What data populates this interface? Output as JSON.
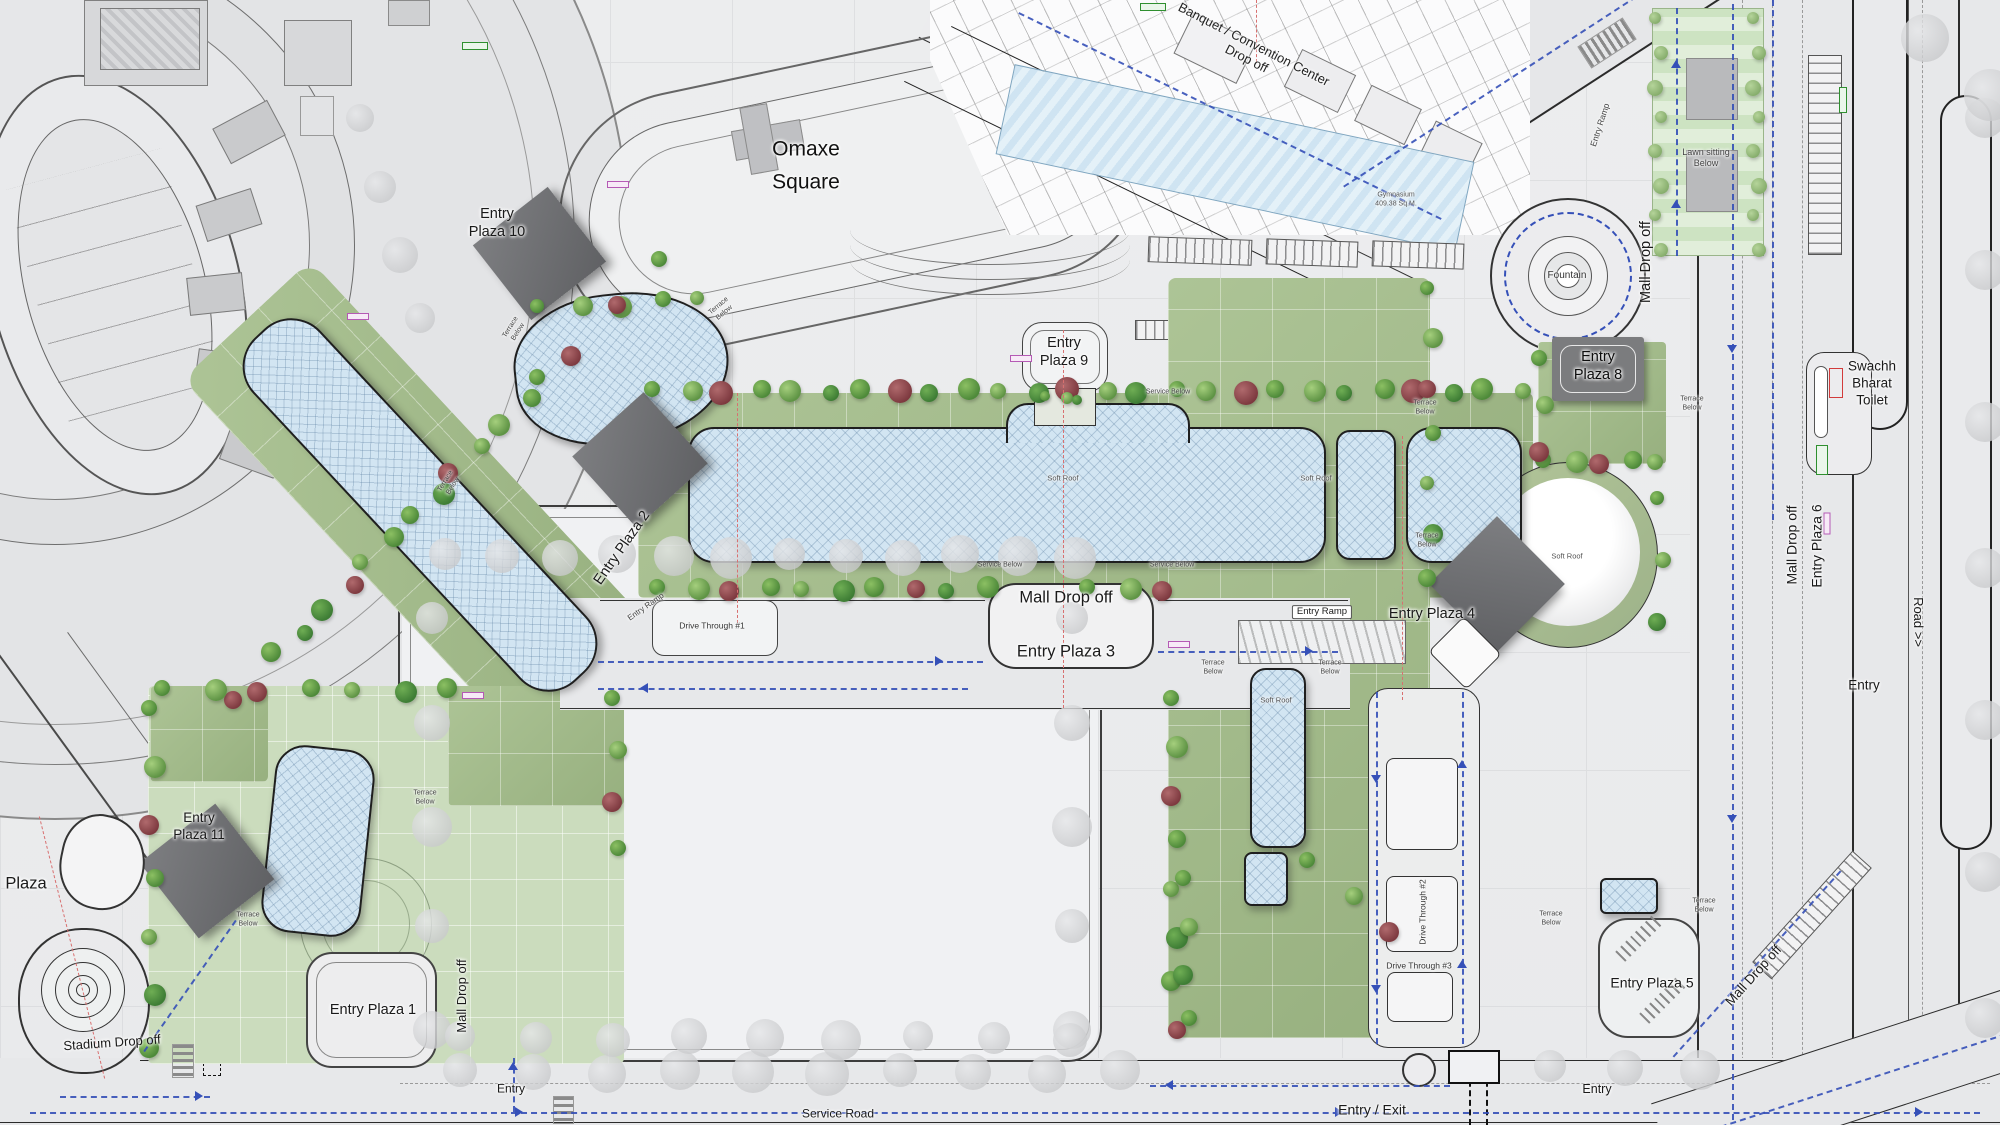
{
  "title": "Omaxe Square mall site plan",
  "colors": {
    "roof_blue": "#d2e5f2",
    "terrace_green": "#a3bb8b",
    "pale_green": "#cbdcbd",
    "plaza_marker_grey": "#6e6f71",
    "traffic_dash_blue": "#3550b8",
    "axis_dash_red": "#d87070",
    "toilet_outline_red": "#d23b3b"
  },
  "annotations": [
    {
      "id": "banquet-convention-drop-off",
      "text": "Banquet / Convention Center\nDrop off",
      "x": 1250,
      "y": 52,
      "s": 13,
      "r": 27,
      "c": "#222"
    },
    {
      "id": "omaxe-square",
      "text": "Omaxe\nSquare",
      "x": 806,
      "y": 166,
      "s": 21,
      "r": 0,
      "c": "#111",
      "lh": 1.55
    },
    {
      "id": "entry-plaza-10",
      "text": "Entry\nPlaza 10",
      "x": 497,
      "y": 223,
      "s": 14.5,
      "r": 0
    },
    {
      "id": "entry-plaza-9",
      "text": "Entry\nPlaza 9",
      "x": 1064,
      "y": 352,
      "s": 14.5,
      "r": 0
    },
    {
      "id": "entry-plaza-8",
      "text": "Entry\nPlaza 8",
      "x": 1598,
      "y": 366,
      "s": 14.5,
      "r": 0,
      "c": "#0d0d0d"
    },
    {
      "id": "fountain",
      "text": "Fountain",
      "x": 1567,
      "y": 276,
      "s": 10,
      "r": 0,
      "c": "#333"
    },
    {
      "id": "mall-drop-off-northeast",
      "text": "Mall Drop off",
      "x": 1646,
      "y": 262,
      "s": 14.5,
      "r": -90
    },
    {
      "id": "lawn-sitting-below",
      "text": "Lawn sitting\nBelow",
      "x": 1706,
      "y": 158,
      "s": 9,
      "r": 0,
      "c": "#444"
    },
    {
      "id": "swachh-bharat-toilet",
      "text": "Swachh\nBharat\nToilet",
      "x": 1872,
      "y": 384,
      "s": 13.5,
      "r": 0
    },
    {
      "id": "mall-drop-off-6",
      "text": "Mall Drop off",
      "x": 1792,
      "y": 545,
      "s": 14,
      "r": -90
    },
    {
      "id": "entry-plaza-6",
      "text": "Entry Plaza 6",
      "x": 1817,
      "y": 546,
      "s": 14,
      "r": -90
    },
    {
      "id": "road-label",
      "text": "Road >>",
      "x": 1918,
      "y": 622,
      "s": 13,
      "r": 90
    },
    {
      "id": "entry-right",
      "text": "Entry",
      "x": 1864,
      "y": 686,
      "s": 13.5,
      "r": 0
    },
    {
      "id": "entry-plaza-4",
      "text": "Entry Plaza 4",
      "x": 1432,
      "y": 614,
      "s": 14.5,
      "r": 0
    },
    {
      "id": "mall-drop-off-center",
      "text": "Mall Drop off",
      "x": 1066,
      "y": 598,
      "s": 16.5,
      "r": 0
    },
    {
      "id": "entry-plaza-3",
      "text": "Entry Plaza 3",
      "x": 1066,
      "y": 652,
      "s": 16.5,
      "r": 0
    },
    {
      "id": "entry-ramp-center",
      "text": "Entry Ramp",
      "x": 1322,
      "y": 612,
      "s": 9.5,
      "r": 0,
      "box": true
    },
    {
      "id": "entry-ramp-left",
      "text": "Entry Ramp",
      "x": 646,
      "y": 607,
      "s": 8,
      "r": -35,
      "c": "#444"
    },
    {
      "id": "entry-ramp-northeast",
      "text": "Entry Ramp",
      "x": 1600,
      "y": 125,
      "s": 8.5,
      "r": -72,
      "c": "#444"
    },
    {
      "id": "entry-plaza-2",
      "text": "Entry Plaza 2",
      "x": 622,
      "y": 548,
      "s": 14.5,
      "r": -55
    },
    {
      "id": "entry-plaza-11",
      "text": "Entry\nPlaza 11",
      "x": 199,
      "y": 827,
      "s": 13.5,
      "r": 0
    },
    {
      "id": "plaza-left",
      "text": "Plaza",
      "x": 26,
      "y": 884,
      "s": 16.5,
      "r": 0
    },
    {
      "id": "stadium-drop-off",
      "text": "Stadium Drop off",
      "x": 112,
      "y": 1043,
      "s": 13,
      "r": -4
    },
    {
      "id": "entry-plaza-1",
      "text": "Entry Plaza 1",
      "x": 373,
      "y": 1010,
      "s": 14.5,
      "r": 0
    },
    {
      "id": "mall-drop-off-southwest",
      "text": "Mall Drop off",
      "x": 462,
      "y": 996,
      "s": 13,
      "r": -90
    },
    {
      "id": "entry-southwest",
      "text": "Entry",
      "x": 511,
      "y": 1089,
      "s": 12,
      "r": 0
    },
    {
      "id": "service-road",
      "text": "Service Road",
      "x": 838,
      "y": 1114,
      "s": 12,
      "r": 0
    },
    {
      "id": "entry-exit",
      "text": "Entry / Exit",
      "x": 1372,
      "y": 1110,
      "s": 14,
      "r": 0
    },
    {
      "id": "entry-southeast",
      "text": "Entry",
      "x": 1597,
      "y": 1090,
      "s": 12.5,
      "r": 0
    },
    {
      "id": "mall-drop-off-southeast",
      "text": "Mall Drop off",
      "x": 1754,
      "y": 976,
      "s": 13.5,
      "r": -48
    },
    {
      "id": "entry-plaza-5",
      "text": "Entry Plaza 5",
      "x": 1652,
      "y": 983,
      "s": 14,
      "r": 0
    },
    {
      "id": "soft-roof-1",
      "text": "Soft Roof",
      "x": 1063,
      "y": 478,
      "s": 7.5,
      "r": 0,
      "c": "#555"
    },
    {
      "id": "soft-roof-2",
      "text": "Soft Roof",
      "x": 1316,
      "y": 478,
      "s": 7.5,
      "r": 0,
      "c": "#555"
    },
    {
      "id": "soft-roof-dome",
      "text": "Soft Roof",
      "x": 1567,
      "y": 556,
      "s": 7.5,
      "r": 0,
      "c": "#555"
    },
    {
      "id": "soft-roof-wing",
      "text": "Soft Roof",
      "x": 1276,
      "y": 700,
      "s": 7.5,
      "r": 0,
      "c": "#555"
    },
    {
      "id": "service-below-1",
      "text": "Service Below",
      "x": 1168,
      "y": 393,
      "s": 7,
      "r": 0,
      "c": "#444"
    },
    {
      "id": "service-below-2",
      "text": "Service Below",
      "x": 1000,
      "y": 566,
      "s": 7,
      "r": 0,
      "c": "#444"
    },
    {
      "id": "service-below-3",
      "text": "Service Below",
      "x": 1172,
      "y": 566,
      "s": 7,
      "r": 0,
      "c": "#444"
    },
    {
      "id": "terrace-below-1",
      "text": "Terrace\nBelow",
      "x": 515,
      "y": 330,
      "s": 7,
      "r": -58,
      "c": "#444"
    },
    {
      "id": "terrace-below-2",
      "text": "Terrace\nBelow",
      "x": 722,
      "y": 310,
      "s": 7,
      "r": -40,
      "c": "#444"
    },
    {
      "id": "terrace-below-3",
      "text": "Terrace\nBelow",
      "x": 425,
      "y": 798,
      "s": 7,
      "r": 0,
      "c": "#444"
    },
    {
      "id": "terrace-below-4",
      "text": "Terrace\nBelow",
      "x": 450,
      "y": 484,
      "s": 7,
      "r": -58,
      "c": "#444"
    },
    {
      "id": "terrace-below-5",
      "text": "Terrace\nBelow",
      "x": 248,
      "y": 920,
      "s": 7,
      "r": 0,
      "c": "#444"
    },
    {
      "id": "terrace-below-6",
      "text": "Terrace\nBelow",
      "x": 1425,
      "y": 408,
      "s": 7,
      "r": 0,
      "c": "#444"
    },
    {
      "id": "terrace-below-7",
      "text": "Terrace\nBelow",
      "x": 1427,
      "y": 541,
      "s": 7,
      "r": 0,
      "c": "#444"
    },
    {
      "id": "terrace-below-8",
      "text": "Terrace\nBelow",
      "x": 1213,
      "y": 668,
      "s": 7,
      "r": 0,
      "c": "#444"
    },
    {
      "id": "terrace-below-9",
      "text": "Terrace\nBelow",
      "x": 1330,
      "y": 668,
      "s": 7,
      "r": 0,
      "c": "#444"
    },
    {
      "id": "terrace-below-10",
      "text": "Terrace\nBelow",
      "x": 1692,
      "y": 404,
      "s": 7,
      "r": 0,
      "c": "#444"
    },
    {
      "id": "terrace-below-11",
      "text": "Terrace\nBelow",
      "x": 1551,
      "y": 919,
      "s": 7,
      "r": 0,
      "c": "#444"
    },
    {
      "id": "terrace-below-12",
      "text": "Terrace\nBelow",
      "x": 1704,
      "y": 906,
      "s": 7,
      "r": 0,
      "c": "#444"
    },
    {
      "id": "drive-through-1",
      "text": "Drive Through #1",
      "x": 712,
      "y": 626,
      "s": 8.5,
      "r": 0,
      "c": "#333"
    },
    {
      "id": "drive-through-2",
      "text": "Drive Through #2",
      "x": 1423,
      "y": 912,
      "s": 8.5,
      "r": -90,
      "c": "#333"
    },
    {
      "id": "drive-through-3",
      "text": "Drive Through #3",
      "x": 1419,
      "y": 966,
      "s": 8.5,
      "r": 0,
      "c": "#333"
    },
    {
      "id": "gymnasium",
      "text": "Gymnasium\n409.38 Sq.M.",
      "x": 1396,
      "y": 200,
      "s": 7,
      "r": 0,
      "c": "#555"
    }
  ]
}
